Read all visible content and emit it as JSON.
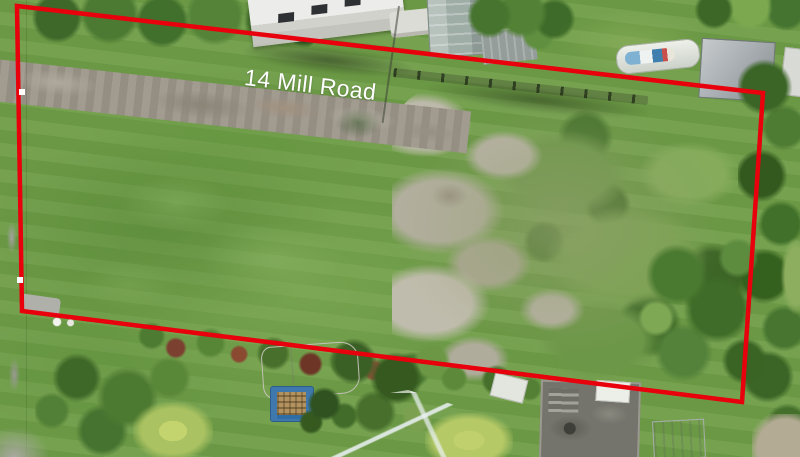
{
  "annotation": {
    "label": "14 Mill Road",
    "label_color": "#ffffff",
    "boundary": {
      "points": "17,6 763,93 742,402 22,311",
      "color": "#e8000c",
      "width": "4.5"
    },
    "markers": [
      {
        "x": 19,
        "y": 89
      },
      {
        "x": 17,
        "y": 277
      }
    ]
  },
  "scene": {
    "type": "aerial-photo",
    "subject": "vacant residential section outlined in red",
    "palette": {
      "lawn": "#6f9d47",
      "dirt": "#b7b3a4",
      "driveway": "#9c968a",
      "road": "#b4b4b0",
      "roof_blue_grey": "#8ba1b2",
      "roof_white": "#ececea",
      "shed_grey": "#aab0b4",
      "trees": "#3f6a2a"
    }
  }
}
